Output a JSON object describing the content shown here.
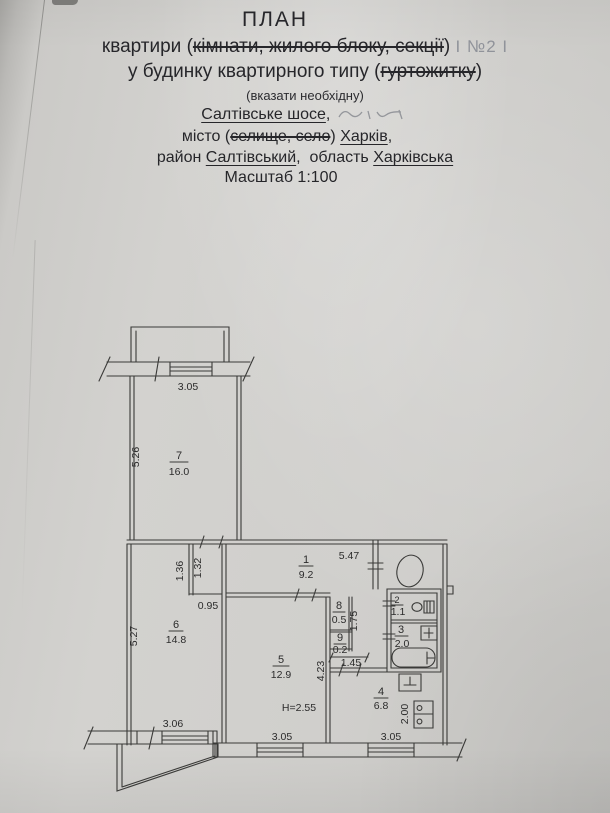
{
  "header": {
    "title": "ПЛАН",
    "line2_prefix": "квартири (",
    "line2_struck": "кімнати, жилого блоку, секції",
    "line2_close": ") ",
    "line2_handwritten": "І №2 І",
    "line3_prefix": "у будинку квартирного типу (",
    "line3_struck": "гуртожитку",
    "line3_close": ")",
    "line4_note": "(вказати необхідну)",
    "line5_street": "Салтівське шосе",
    "line5_comma": ", ",
    "line6_prefix": "місто (",
    "line6_struck": "селище, село",
    "line6_close": ") ",
    "line6_city": "Харків",
    "line6_comma": ",",
    "line7_prefix": "район ",
    "line7_district": "Салтівський",
    "line7_mid": ",  область ",
    "line7_region": "Харківська",
    "line8_scale": "Масштаб 1:100"
  },
  "plan": {
    "room1_number": "1",
    "room1_area": "9.2",
    "room2_number": "2",
    "room2_area": "1.1",
    "room3_number": "3",
    "room3_area": "2.0",
    "room4_number": "4",
    "room4_area": "6.8",
    "room5_number": "5",
    "room5_area": "12.9",
    "room6_number": "6",
    "room6_area": "14.8",
    "room7_number": "7",
    "room7_area": "16.0",
    "room8_number": "8",
    "room8_area": "0.5",
    "room9_number": "9",
    "room9_area": "0.2",
    "dim_top_window": "3.05",
    "dim_room7_left": "5.26",
    "dim_corridor_top": "5.47",
    "dim_niche_left": "1.36",
    "dim_niche_right": "1.32",
    "dim_niche_width": "0.95",
    "dim_room6_left": "5.27",
    "dim_room6_window": "3.06",
    "dim_room5_window": "3.05",
    "dim_room5_depth": "4.23",
    "dim_closet": "1.75",
    "dim_passage": "1.45",
    "dim_kitchen_window": "3.05",
    "dim_stove": "2.00",
    "ceiling_height": "H=2.55"
  }
}
